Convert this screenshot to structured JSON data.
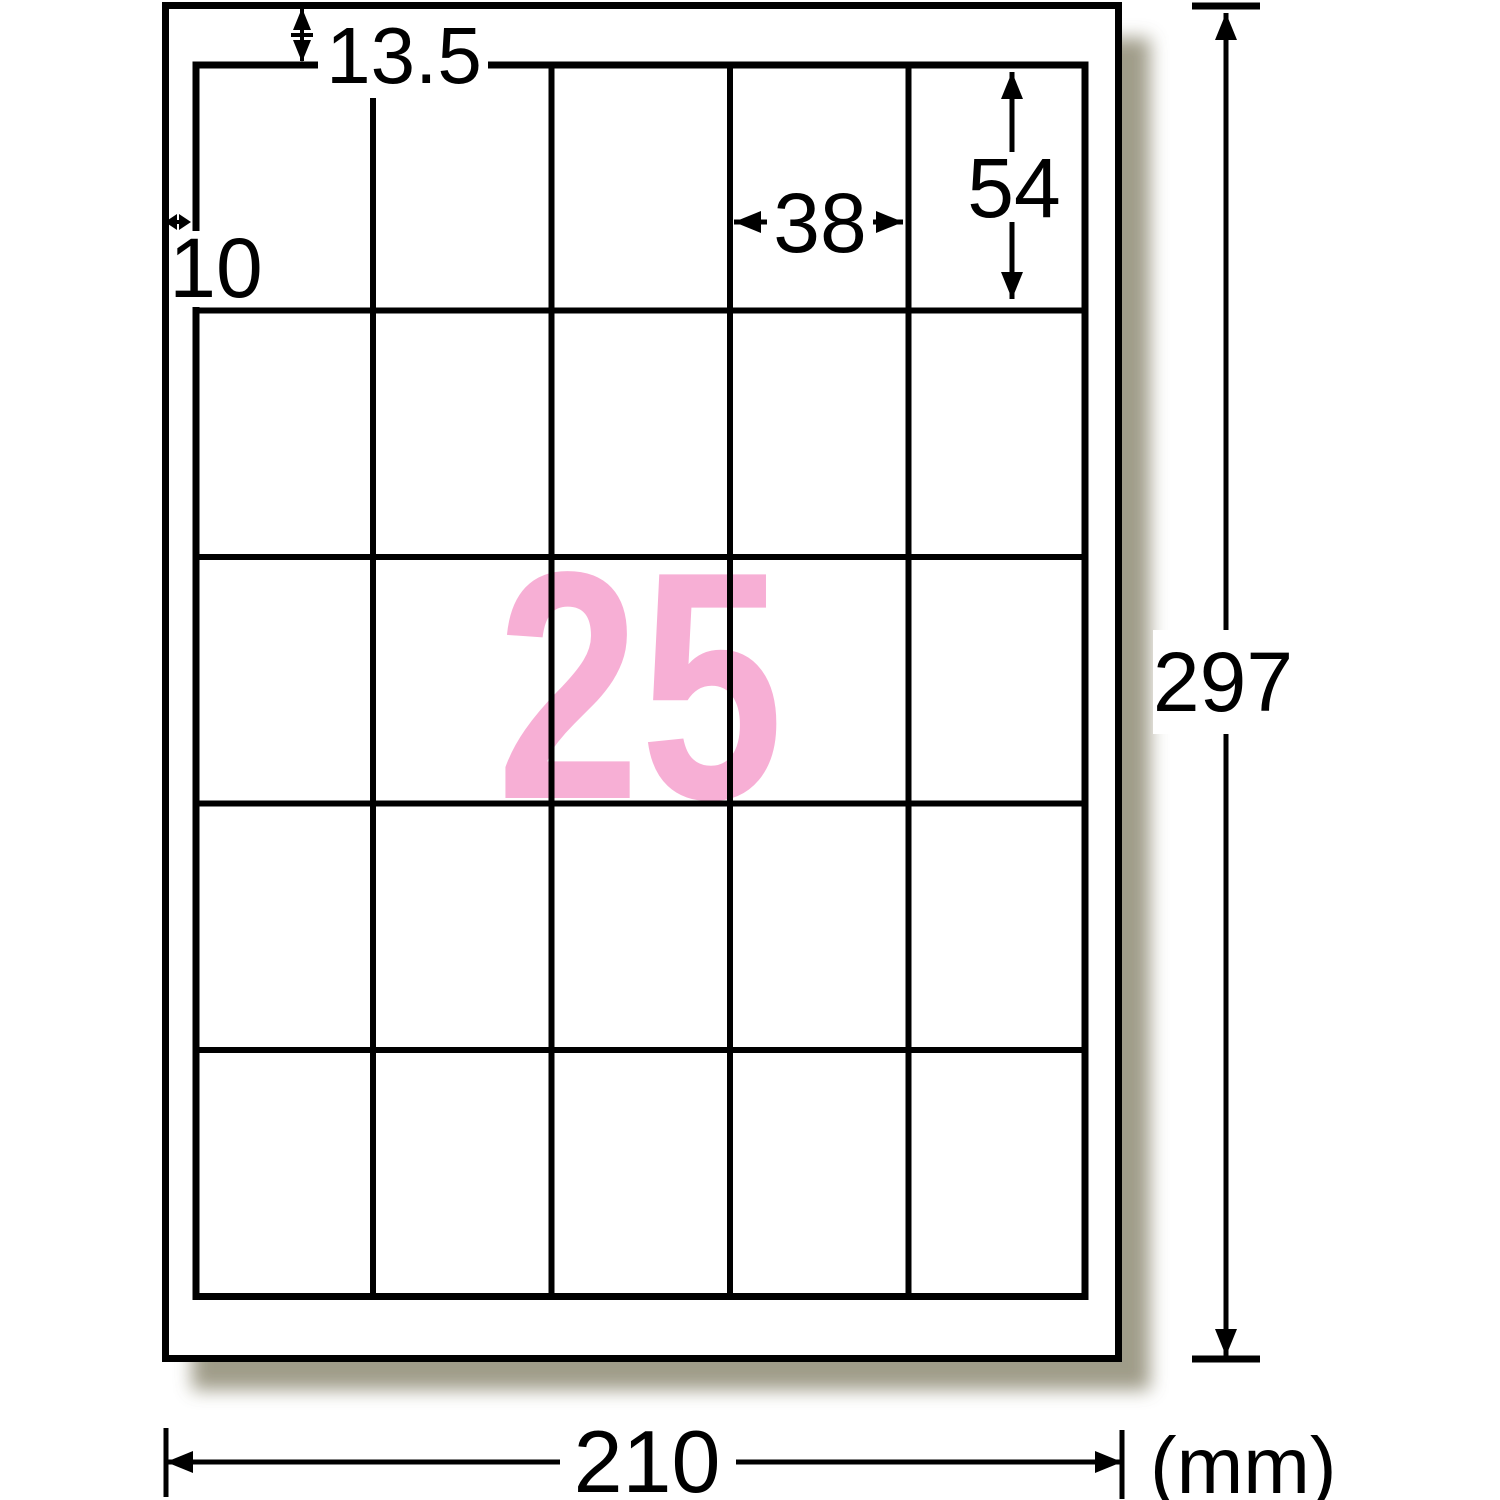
{
  "diagram": {
    "count_overlay": "25",
    "unit": "(mm)",
    "dims": {
      "top_margin": "13.5",
      "left_margin": "10",
      "label_width": "38",
      "label_height": "54",
      "page_height": "297",
      "page_width": "210"
    },
    "grid": {
      "rows": "5",
      "columns": "5"
    },
    "colors": {
      "accent_pink": "#F7AFD5",
      "line": "#000000",
      "shadow": "#8F8B74"
    }
  }
}
